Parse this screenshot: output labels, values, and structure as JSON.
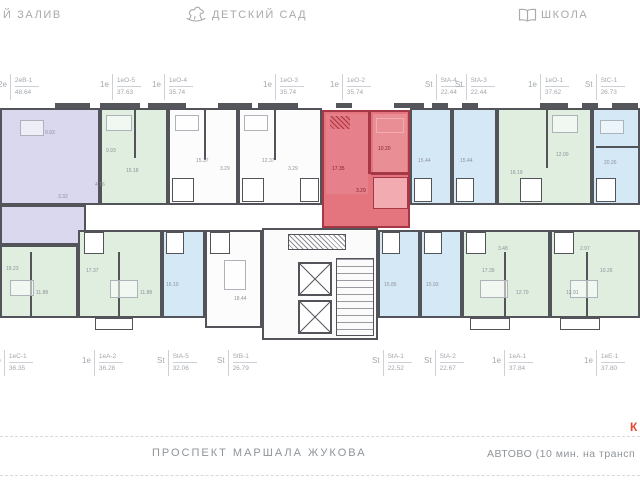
{
  "header": {
    "bay_label": "Й ЗАЛИВ",
    "kindergarten_label": "ДЕТСКИЙ САД",
    "school_label": "ШКОЛА"
  },
  "top_units": [
    {
      "prefix": "2е",
      "code": "2еВ-1",
      "area": "48.64"
    },
    {
      "prefix": "1е",
      "code": "1еО-5",
      "area": "37.63"
    },
    {
      "prefix": "1е",
      "code": "1еО-4",
      "area": "35.74"
    },
    {
      "prefix": "1е",
      "code": "1еО-3",
      "area": "35.74"
    },
    {
      "prefix": "1е",
      "code": "1еО-2",
      "area": "35.74"
    },
    {
      "prefix": "St",
      "code": "StА-4",
      "area": "22.44"
    },
    {
      "prefix": "St",
      "code": "StА-3",
      "area": "22.44"
    },
    {
      "prefix": "1е",
      "code": "1еО-1",
      "area": "37.62"
    },
    {
      "prefix": "St",
      "code": "StС-1",
      "area": "26.73"
    }
  ],
  "bottom_units": [
    {
      "prefix": "1е",
      "code": "1еС-1",
      "area": "36.35"
    },
    {
      "prefix": "1е",
      "code": "1еА-2",
      "area": "36.28"
    },
    {
      "prefix": "St",
      "code": "StА-5",
      "area": "32.06"
    },
    {
      "prefix": "St",
      "code": "StВ-1",
      "area": "26.79"
    },
    {
      "prefix": "St",
      "code": "StА-1",
      "area": "22.52"
    },
    {
      "prefix": "St",
      "code": "StА-2",
      "area": "22.67"
    },
    {
      "prefix": "1е",
      "code": "1еА-1",
      "area": "37.84"
    },
    {
      "prefix": "1е",
      "code": "1еЕ-1",
      "area": "37.80"
    }
  ],
  "plan": {
    "highlighted_unit_code": "1еО-2",
    "highlighted_unit_area": "35.74",
    "room_labels": [
      "9.93",
      "4.76",
      "3.32",
      "9.93",
      "15.18",
      "15.37",
      "3.29",
      "12.37",
      "3.29",
      "17.35",
      "10.20",
      "3.29",
      "15.44",
      "15.44",
      "18.19",
      "12.00",
      "20.26",
      "18.23",
      "11.88",
      "17.37",
      "11.88",
      "16.10",
      "18.44",
      "15.85",
      "15.93",
      "17.39",
      "12.70",
      "3.48",
      "12.91",
      "10.26",
      "2.97"
    ]
  },
  "footer": {
    "street_label": "ПРОСПЕКТ МАРШАЛА ЖУКОВА",
    "metro_label": "АВТОВО (10 мин. на трансп",
    "compass_letter": "К"
  },
  "colors": {
    "highlight": "#e4747e",
    "highlight_wall": "#a63744",
    "unit_purple": "#d9d8ef",
    "unit_green": "#e0eee0",
    "unit_blue": "#d4e8f6",
    "wall": "#53535a"
  }
}
